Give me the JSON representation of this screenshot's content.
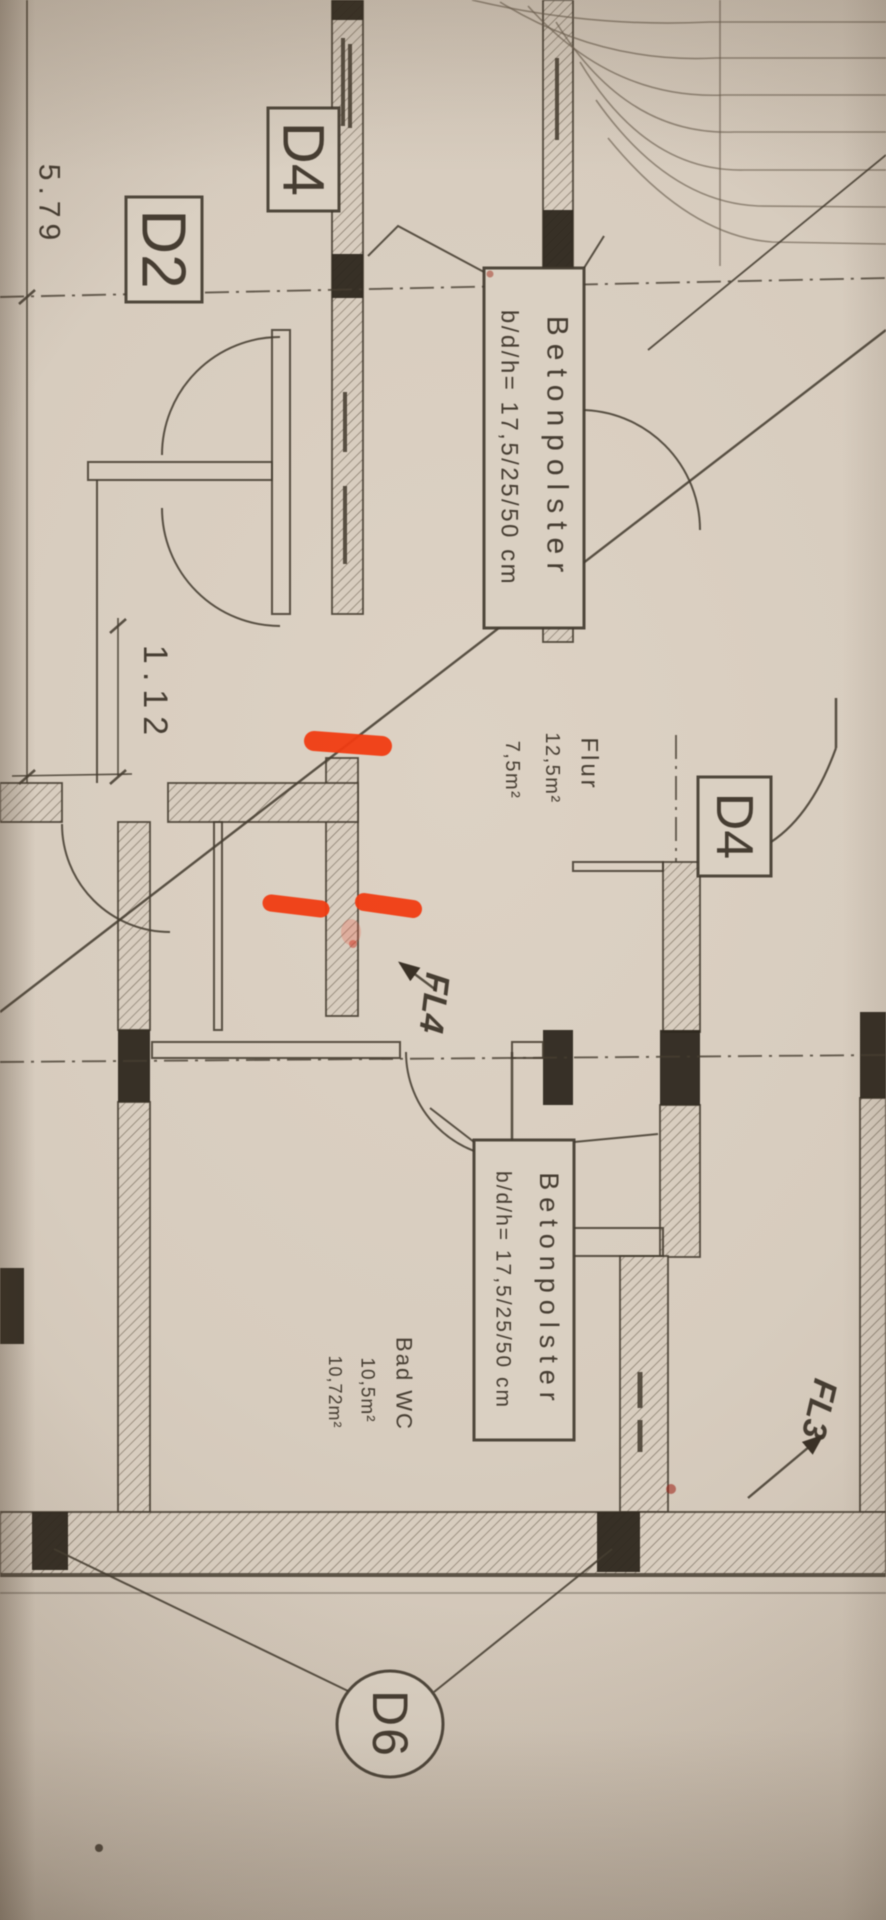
{
  "photo": {
    "type": "floor-plan-photo",
    "marker_color": "#f03c12",
    "paper_color": "#d7ccbe",
    "ink_color": "#463d31"
  },
  "labels": {
    "d4_top": "D4",
    "d2_left": "D2",
    "d4_right": "D4",
    "d6_bottom": "D6",
    "fl4": "FL4",
    "fl3": "FL3"
  },
  "dimensions": {
    "dim_main": "5.79",
    "dim_opening": "1.12"
  },
  "notes": {
    "betonpolster_upper_line1": "Betonpolster",
    "betonpolster_upper_line2": "b/d/h= 17,5/25/50 cm",
    "betonpolster_lower_line1": "Betonpolster",
    "betonpolster_lower_line2": "b/d/h= 17,5/25/50 cm"
  },
  "rooms": {
    "flur_name": "Flur",
    "flur_area1": "12,5m²",
    "flur_area2": "7,5m²",
    "badwc_name": "Bad WC",
    "badwc_area1": "10,5m²",
    "badwc_area2": "10,72m²"
  }
}
